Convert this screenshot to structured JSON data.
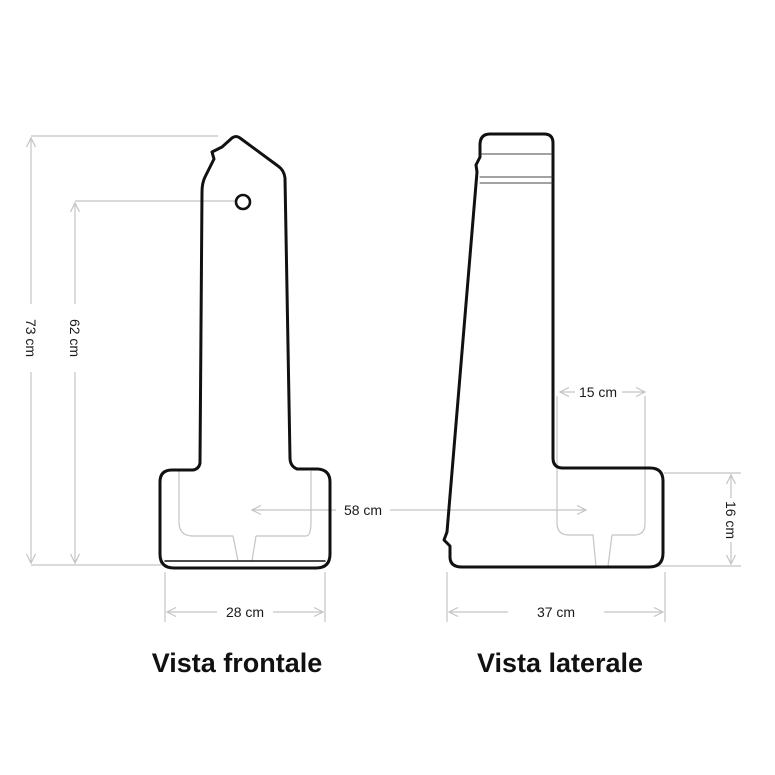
{
  "diagram": {
    "front_view": {
      "title": "Vista frontale",
      "dim_total_height": "73 cm",
      "dim_hole_height": "62 cm",
      "dim_base_width": "28 cm"
    },
    "side_view": {
      "title": "Vista laterale",
      "dim_column_depth": "15 cm",
      "dim_base_height": "16 cm",
      "dim_base_depth": "37 cm"
    },
    "shared": {
      "dim_span": "58 cm"
    },
    "colors": {
      "outline": "#111111",
      "dimension": "#c4c4c4",
      "label_text": "#1a1a1a"
    }
  }
}
